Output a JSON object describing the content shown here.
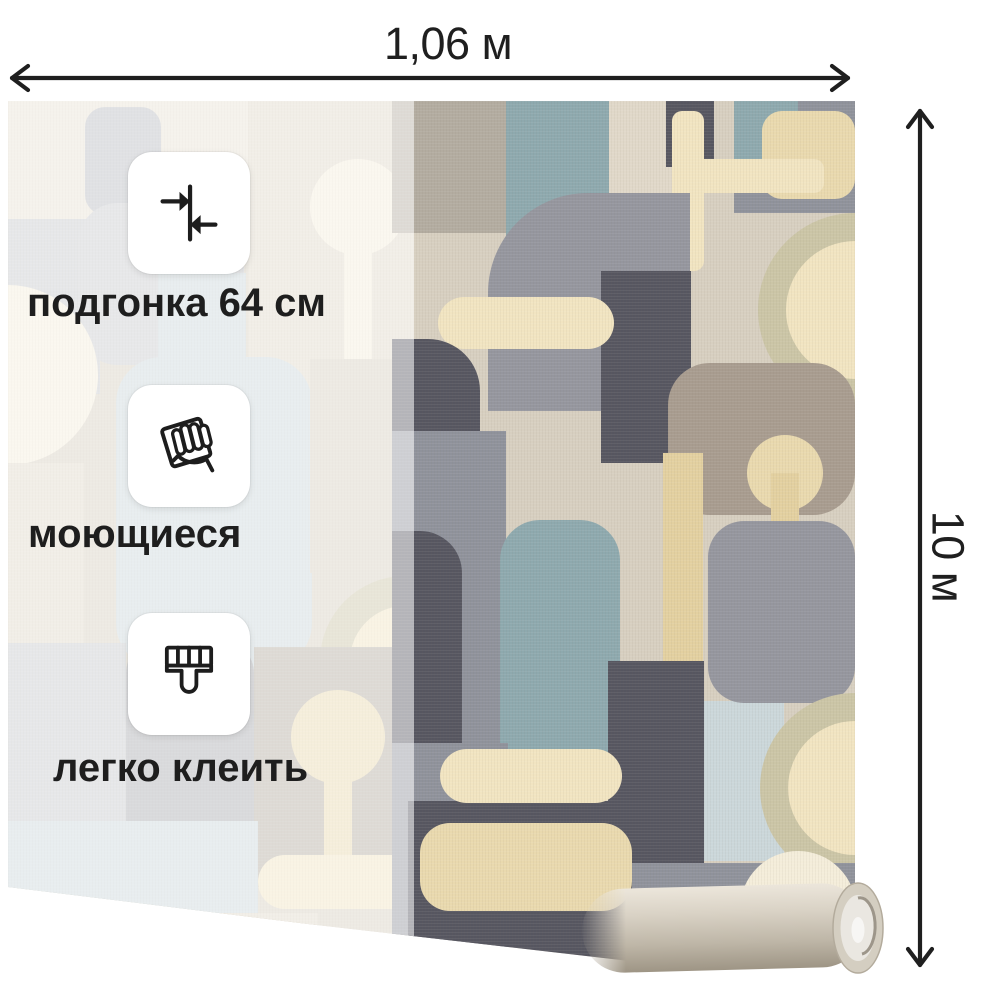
{
  "product": {
    "width_label": "1,06 м",
    "height_label": "10 м"
  },
  "features": [
    {
      "icon": "pattern-match-icon",
      "label": "подгонка 64 см"
    },
    {
      "icon": "washable-icon",
      "label": "моющиеся"
    },
    {
      "icon": "easy-glue-icon",
      "label": "легко клеить"
    }
  ],
  "colors": {
    "background": "#ffffff",
    "annotation_text": "#1f1f1f",
    "arrow": "#1f1f1f",
    "badge_background": "#ffffff",
    "overlay_white": "rgba(255,255,255,0.56)",
    "palette": {
      "linen": "#d7cfc0",
      "linen2": "#e0d8c9",
      "pale_linen": "#e8e1d3",
      "cream": "#f1e4c1",
      "cream_pale": "#f4edda",
      "cream_tex": "#e9d9ae",
      "gold": "#e3d0a0",
      "teal": "#8ea9ae",
      "pale_blue": "#cbd7da",
      "light_gray": "#c7c9cc",
      "gray2": "#a9abb0",
      "mid_gray": "#95969e",
      "slate_gray": "#8f929b",
      "charcoal": "#565660",
      "taupe": "#a89c8f",
      "taupe_light": "#b3aca0",
      "ring": "#cbc5a6",
      "gray_blue": "#b9bcc1"
    }
  },
  "wallpaper": {
    "pattern_shapes": [
      {
        "t": "r",
        "x": 0,
        "y": 0,
        "w": 847,
        "h": 864,
        "f": "linen"
      },
      {
        "t": "r",
        "x": 0,
        "y": 0,
        "w": 250,
        "h": 125,
        "f": "pale_linen"
      },
      {
        "t": "r",
        "x": 77,
        "y": 6,
        "w": 76,
        "h": 108,
        "rx": 20,
        "f": "gray_blue"
      },
      {
        "t": "r",
        "x": 240,
        "y": 0,
        "w": 166,
        "h": 305,
        "f": "linen2"
      },
      {
        "t": "c",
        "x": 350,
        "y": 106,
        "r": 48,
        "f": "cream_pale"
      },
      {
        "t": "r",
        "x": 336,
        "y": 106,
        "w": 28,
        "h": 192,
        "f": "cream_pale"
      },
      {
        "t": "r",
        "x": 0,
        "y": 118,
        "w": 92,
        "h": 175,
        "f": "light_gray"
      },
      {
        "t": "r",
        "x": 70,
        "y": 102,
        "w": 166,
        "h": 162,
        "rx": 40,
        "f": "#c9cbce"
      },
      {
        "t": "r",
        "x": 150,
        "y": 172,
        "w": 88,
        "h": 150,
        "f": "pale_blue"
      },
      {
        "t": "p",
        "d": "M0,184 a90,90 0 0 1 0,180 Z",
        "f": "cream_pale"
      },
      {
        "t": "r",
        "x": 0,
        "y": 362,
        "w": 76,
        "h": 180,
        "f": "linen2"
      },
      {
        "t": "r",
        "x": 108,
        "y": 256,
        "w": 196,
        "h": 312,
        "rx": 46,
        "f": "pale_blue"
      },
      {
        "t": "r",
        "x": 302,
        "y": 258,
        "w": 104,
        "h": 214,
        "f": "linen"
      },
      {
        "t": "p",
        "d": "M312,560 a85,85 0 0 1 170,0 Z",
        "f": "ring"
      },
      {
        "t": "p",
        "d": "M342,560 a55,55 0 0 1 110,0 Z",
        "f": "cream"
      },
      {
        "t": "r",
        "x": 0,
        "y": 542,
        "w": 118,
        "h": 178,
        "f": "light_gray"
      },
      {
        "t": "r",
        "x": 118,
        "y": 540,
        "w": 128,
        "h": 232,
        "rx": 32,
        "f": "gray2"
      },
      {
        "t": "r",
        "x": 246,
        "y": 546,
        "w": 160,
        "h": 240,
        "f": "taupe_light"
      },
      {
        "t": "c",
        "x": 330,
        "y": 636,
        "r": 47,
        "f": "cream_tex"
      },
      {
        "t": "r",
        "x": 316,
        "y": 636,
        "w": 28,
        "h": 132,
        "f": "cream_tex"
      },
      {
        "t": "r",
        "x": 0,
        "y": 720,
        "w": 250,
        "h": 92,
        "f": "pale_blue"
      },
      {
        "t": "r",
        "x": 250,
        "y": 754,
        "w": 300,
        "h": 54,
        "rx": 27,
        "f": "cream"
      },
      {
        "t": "r",
        "x": 0,
        "y": 812,
        "w": 310,
        "h": 52,
        "f": "linen2"
      },
      {
        "t": "r",
        "x": 384,
        "y": 0,
        "w": 125,
        "h": 132,
        "f": "taupe_light"
      },
      {
        "t": "p",
        "d": "M498,0 h112 v136 a40,40 0 0 1 -40,40 h-32 a40,40 0 0 1 -40,-40 Z",
        "f": "teal"
      },
      {
        "t": "r",
        "x": 601,
        "y": 0,
        "w": 92,
        "h": 152,
        "f": "linen2"
      },
      {
        "t": "r",
        "x": 658,
        "y": 0,
        "w": 48,
        "h": 66,
        "f": "charcoal"
      },
      {
        "t": "r",
        "x": 726,
        "y": 0,
        "w": 121,
        "h": 112,
        "f": "slate_gray"
      },
      {
        "t": "r",
        "x": 726,
        "y": 0,
        "w": 64,
        "h": 66,
        "f": "teal"
      },
      {
        "t": "r",
        "x": 754,
        "y": 10,
        "w": 93,
        "h": 88,
        "rx": 20,
        "f": "cream_tex"
      },
      {
        "t": "r",
        "x": 664,
        "y": 10,
        "w": 32,
        "h": 160,
        "rx": 10,
        "f": "cream"
      },
      {
        "t": "r",
        "x": 664,
        "y": 58,
        "w": 152,
        "h": 34,
        "rx": 10,
        "f": "cream"
      },
      {
        "t": "p",
        "d": "M480,310 v-118 a100,100 0 0 1 100,-100 h102 v218 Z",
        "f": "mid_gray"
      },
      {
        "t": "r",
        "x": 593,
        "y": 170,
        "w": 90,
        "h": 192,
        "f": "charcoal"
      },
      {
        "t": "r",
        "x": 430,
        "y": 196,
        "w": 176,
        "h": 52,
        "rx": 26,
        "f": "cream"
      },
      {
        "t": "p",
        "d": "M384,238 h36 a52,52 0 0 1 52,52 v70 h-88 Z",
        "f": "charcoal"
      },
      {
        "t": "p",
        "d": "M847,112 a97,97 0 0 0 -97,97 a97,97 0 0 0 97,97 Z",
        "f": "ring"
      },
      {
        "t": "p",
        "d": "M847,140 a69,69 0 0 0 -69,69 a69,69 0 0 0 69,69 Z",
        "f": "cream"
      },
      {
        "t": "r",
        "x": 660,
        "y": 262,
        "w": 187,
        "h": 152,
        "rx": 42,
        "f": "taupe"
      },
      {
        "t": "c",
        "x": 777,
        "y": 372,
        "r": 38,
        "f": "cream_tex"
      },
      {
        "t": "r",
        "x": 763,
        "y": 372,
        "w": 28,
        "h": 142,
        "f": "gold"
      },
      {
        "t": "r",
        "x": 384,
        "y": 330,
        "w": 114,
        "h": 312,
        "f": "slate_gray"
      },
      {
        "t": "p",
        "d": "M384,430 h28 a42,42 0 0 1 42,42 v170 h-70 Z",
        "f": "charcoal"
      },
      {
        "t": "r",
        "x": 492,
        "y": 419,
        "w": 120,
        "h": 278,
        "rx": 40,
        "f": "teal"
      },
      {
        "t": "r",
        "x": 612,
        "y": 362,
        "w": 74,
        "h": 300,
        "f": "linen"
      },
      {
        "t": "r",
        "x": 655,
        "y": 352,
        "w": 40,
        "h": 330,
        "f": "gold"
      },
      {
        "t": "r",
        "x": 696,
        "y": 600,
        "w": 80,
        "h": 160,
        "f": "pale_blue"
      },
      {
        "t": "r",
        "x": 700,
        "y": 420,
        "w": 147,
        "h": 182,
        "rx": 36,
        "f": "mid_gray"
      },
      {
        "t": "p",
        "d": "M847,592 a95,95 0 0 0 -95,95 a95,95 0 0 0 95,95 Z",
        "f": "ring"
      },
      {
        "t": "p",
        "d": "M847,620 a67,67 0 0 0 -67,67 a67,67 0 0 0 67,67 Z",
        "f": "cream"
      },
      {
        "t": "r",
        "x": 600,
        "y": 560,
        "w": 96,
        "h": 260,
        "f": "charcoal"
      },
      {
        "t": "r",
        "x": 384,
        "y": 642,
        "w": 116,
        "h": 222,
        "f": "slate_gray"
      },
      {
        "t": "r",
        "x": 400,
        "y": 700,
        "w": 222,
        "h": 164,
        "f": "charcoal"
      },
      {
        "t": "r",
        "x": 412,
        "y": 722,
        "w": 212,
        "h": 88,
        "rx": 30,
        "f": "cream_tex"
      },
      {
        "t": "r",
        "x": 432,
        "y": 648,
        "w": 182,
        "h": 54,
        "rx": 27,
        "f": "cream"
      },
      {
        "t": "r",
        "x": 624,
        "y": 762,
        "w": 223,
        "h": 102,
        "f": "slate_gray"
      },
      {
        "t": "c",
        "x": 790,
        "y": 808,
        "r": 58,
        "f": "cream_pale"
      }
    ]
  }
}
